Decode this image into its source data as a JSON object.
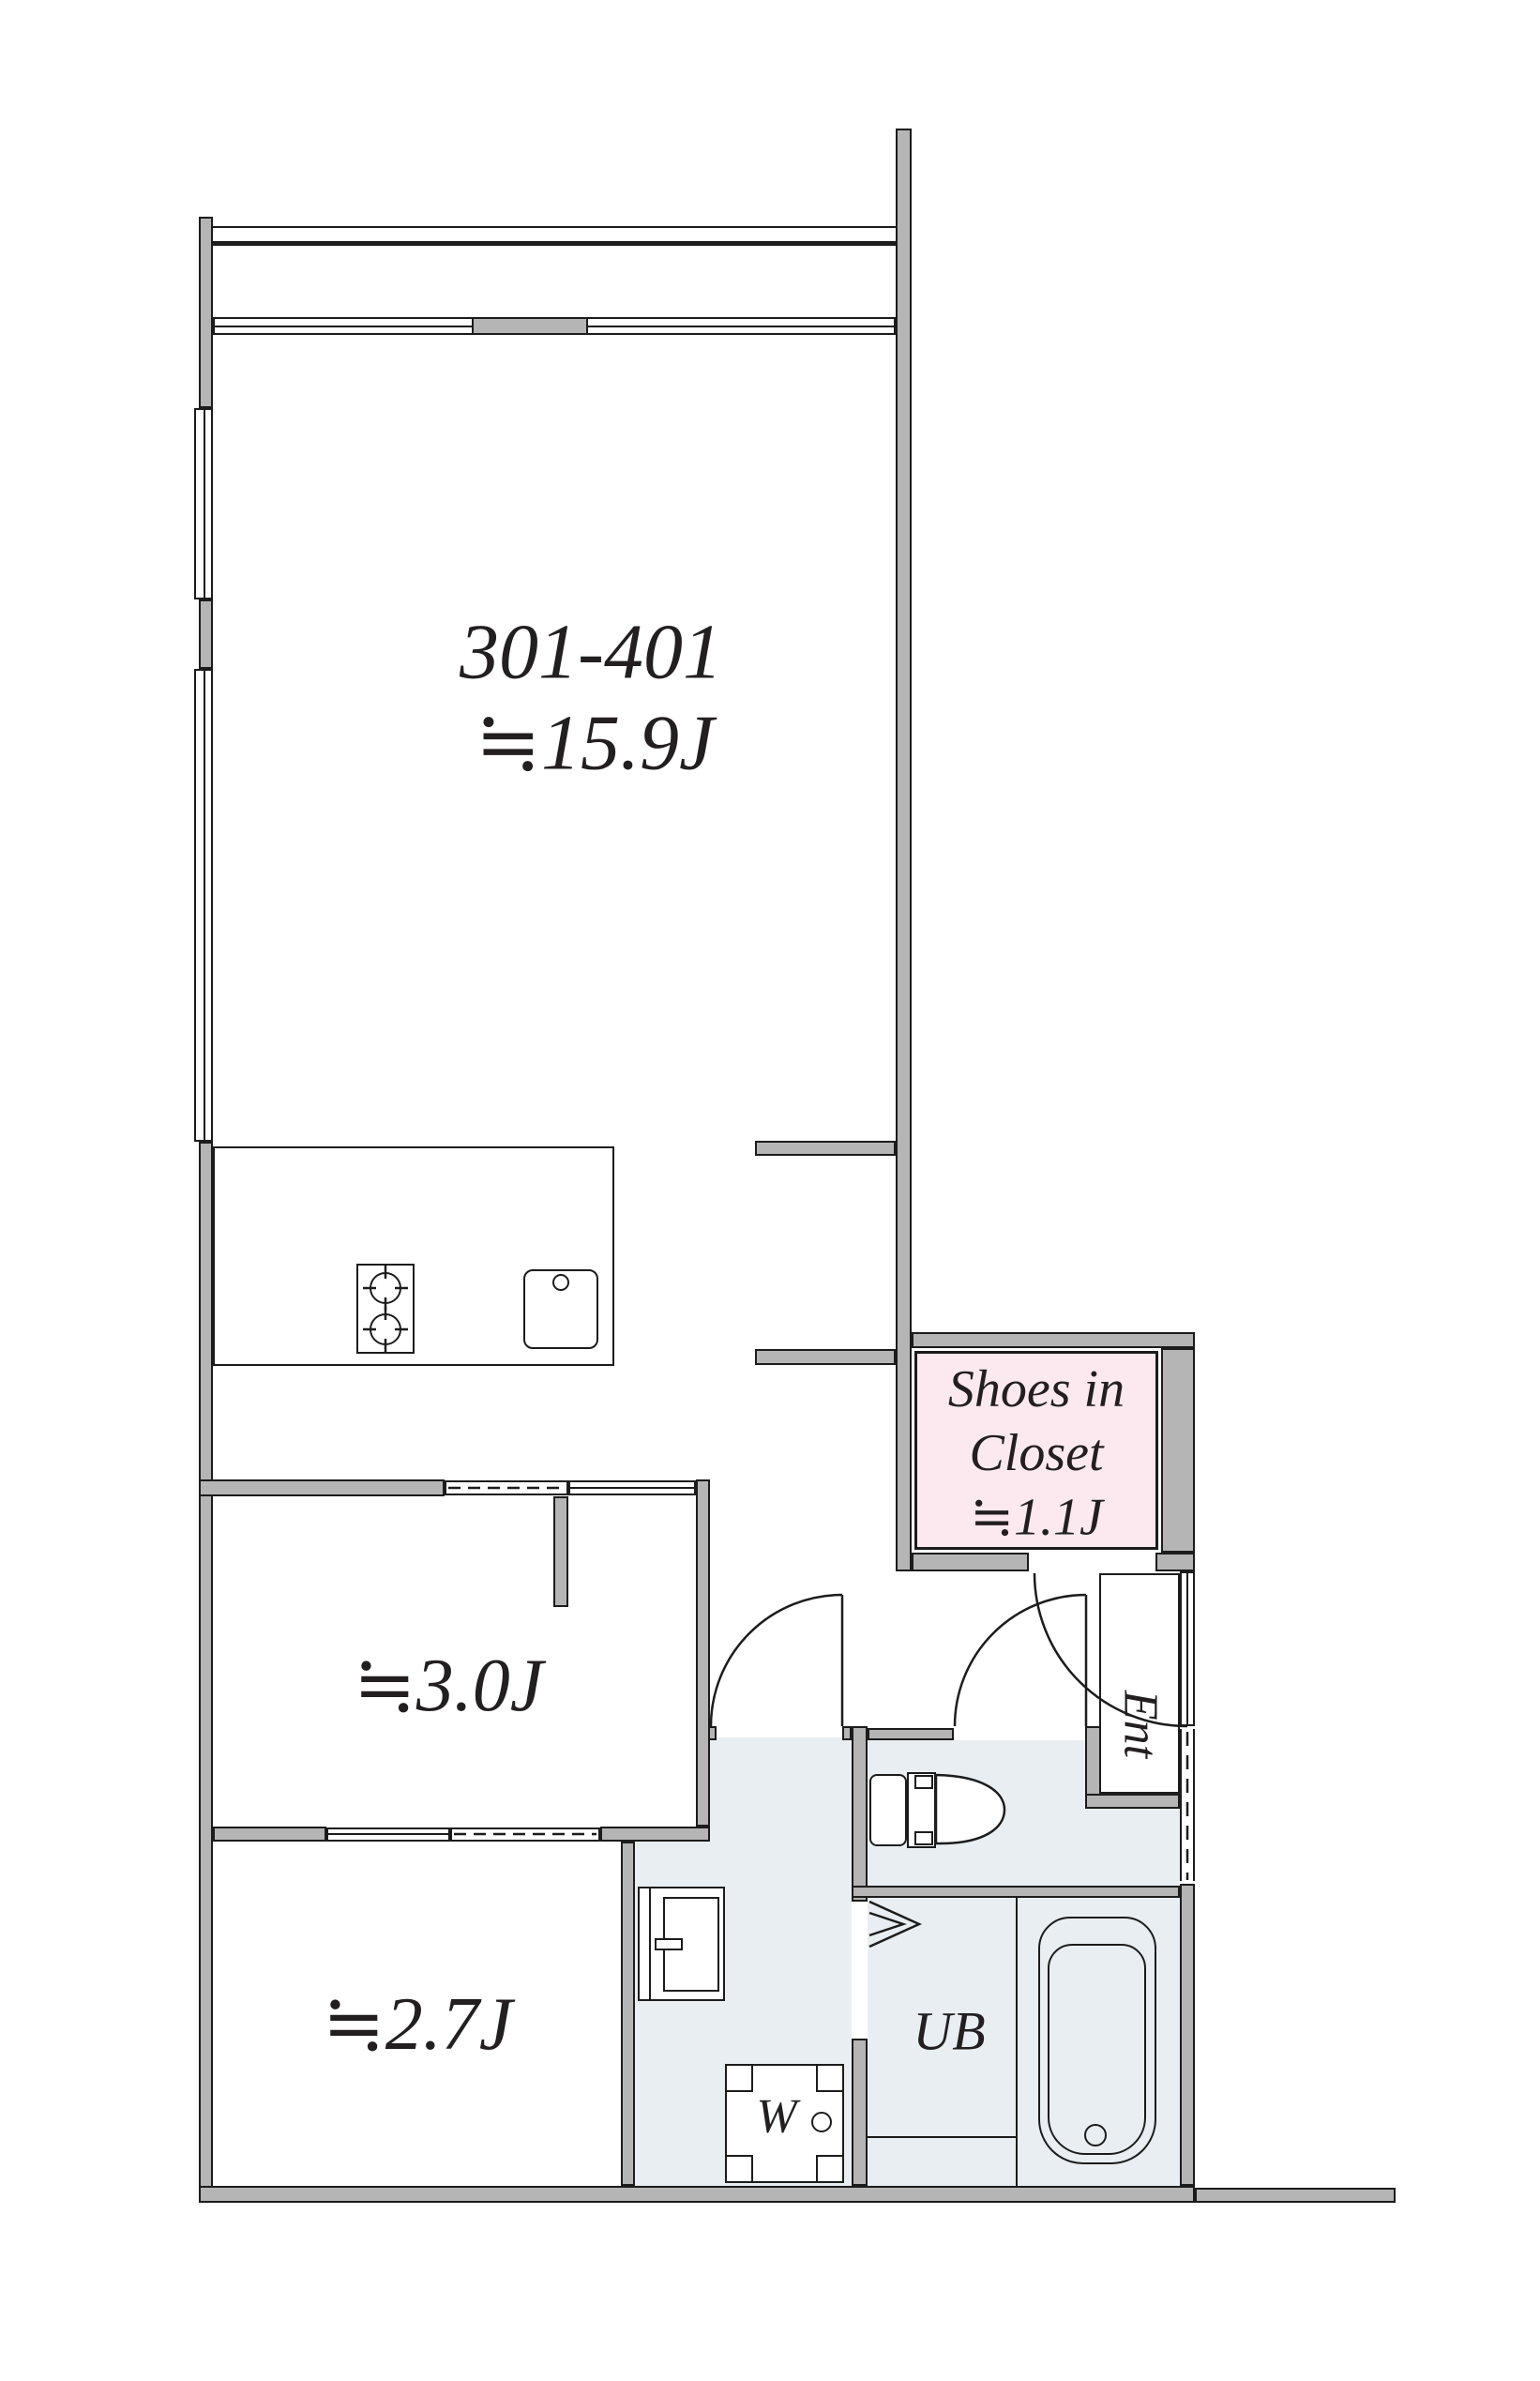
{
  "plan_type": "apartment-floorplan",
  "labels": {
    "unit_number": "301-401",
    "living_area": "≒15.9J",
    "room_3_0": "≒3.0J",
    "room_2_7": "≒2.7J",
    "shoes_closet_line1": "Shoes in",
    "shoes_closet_line2": "Closet",
    "shoes_closet_area": "≒1.1J",
    "entrance": "Ent",
    "unit_bath": "UB",
    "washer": "W"
  },
  "colors": {
    "wall_fill": "#b5b5b5",
    "outline": "#1c1c1c",
    "wet_area_floor": "#e8eef1",
    "shoes_closet_fill": "#fbe9ef",
    "background": "#ffffff"
  }
}
